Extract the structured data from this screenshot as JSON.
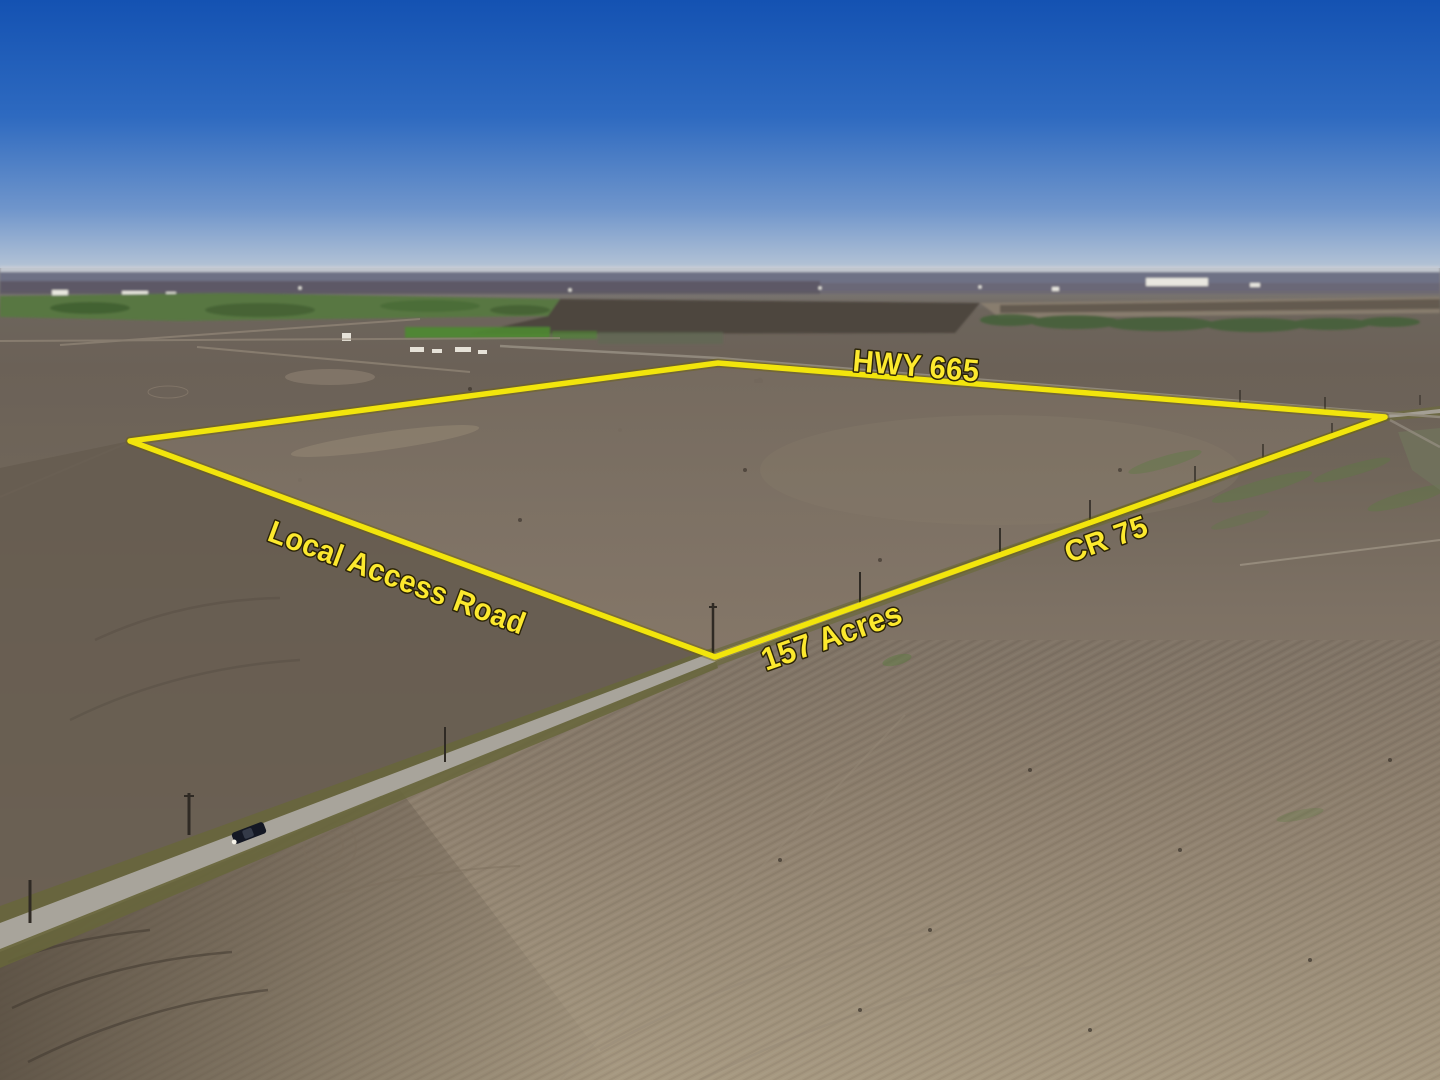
{
  "meta": {
    "type": "aerial-drone-photograph",
    "subject": "farm land parcel for sale with yellow boundary overlay"
  },
  "annotations": {
    "highway_label": "HWY 665",
    "access_road_label": "Local Access Road",
    "county_road_label": "CR 75",
    "acreage_label": "157 Acres",
    "boundary_color": "#f2e50c",
    "label_fill": "#fce92e",
    "label_outline": "#2b2408"
  },
  "scene": {
    "sky_top_color": "#1452b2",
    "sky_horizon_color": "#c2cbd6",
    "plowed_dark_color": "#5f5447",
    "field_taupe_color": "#7d7164",
    "field_tan_color": "#a69880",
    "grass_green_color": "#587743",
    "road_gray_color": "#a8a49b"
  }
}
